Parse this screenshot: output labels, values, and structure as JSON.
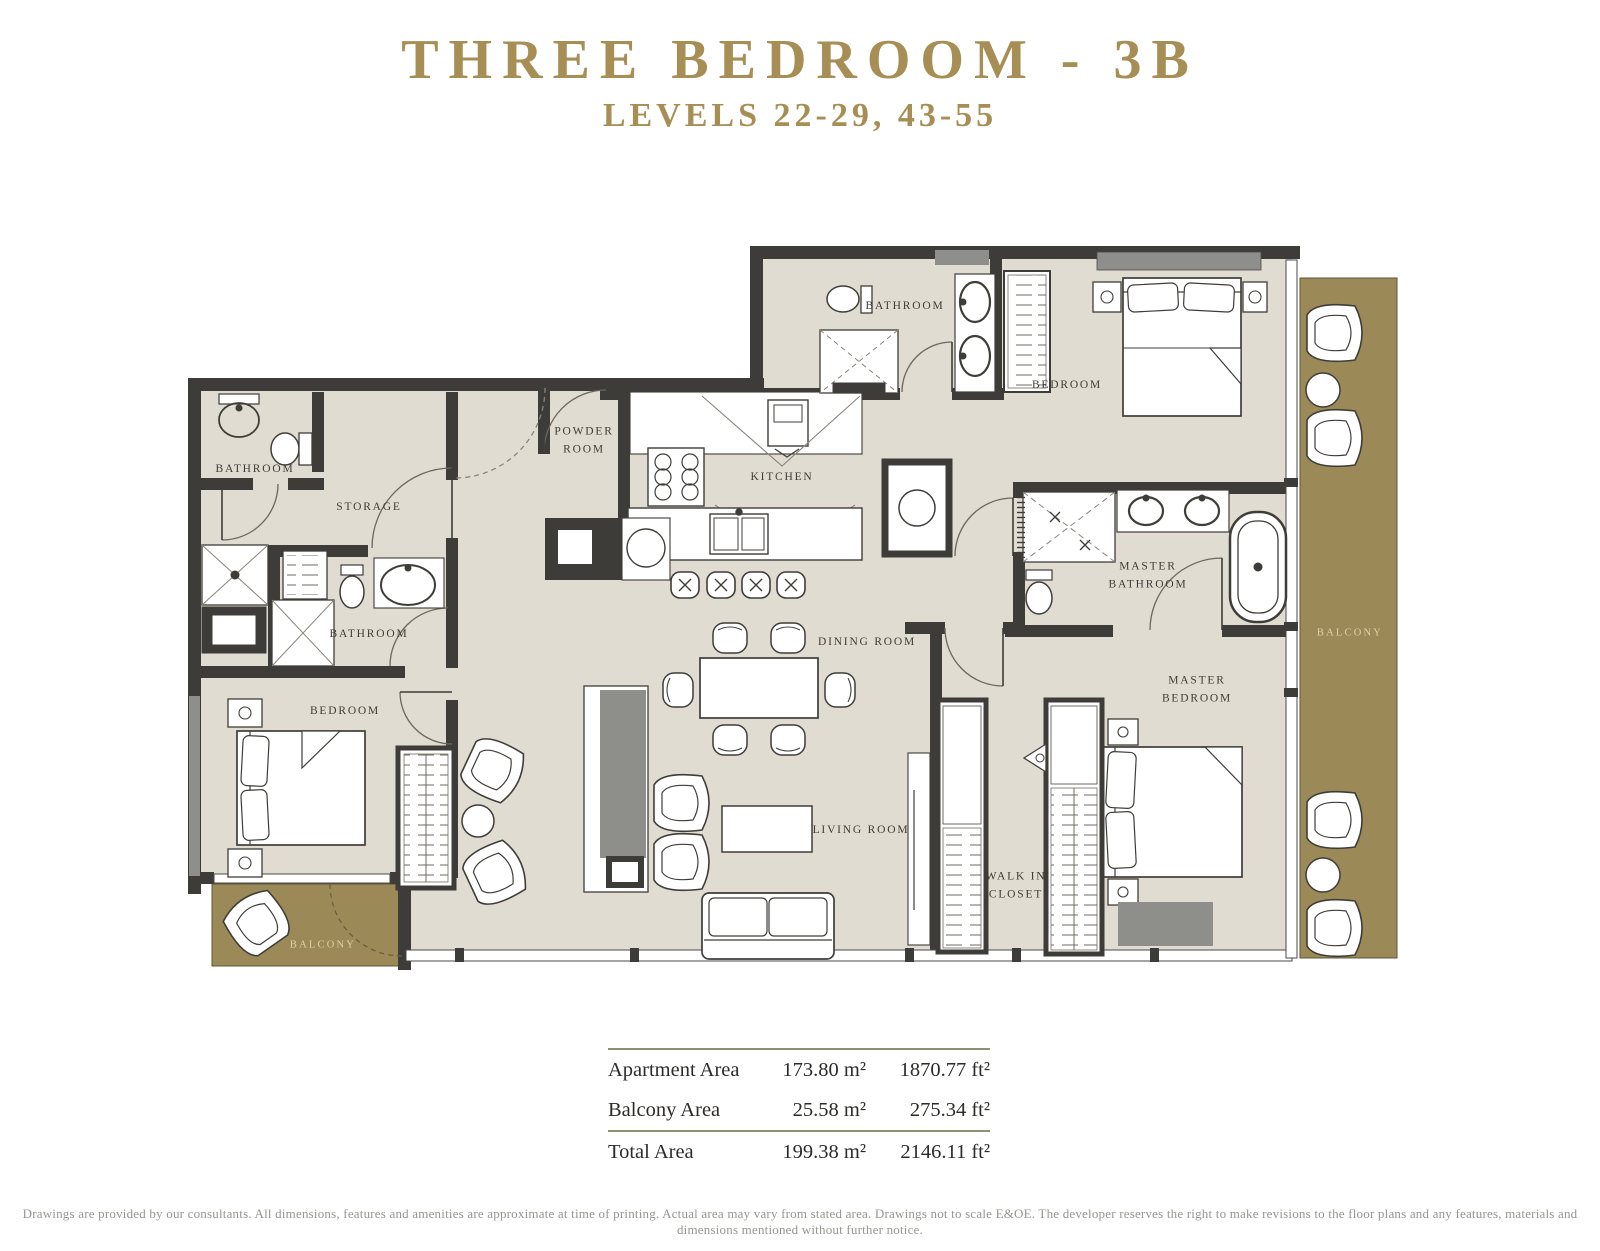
{
  "header": {
    "title": "THREE BEDROOM - 3B",
    "subtitle": "LEVELS 22-29, 43-55"
  },
  "floorplan": {
    "rooms": [
      {
        "id": "bathroom-1",
        "label": "BATHROOM"
      },
      {
        "id": "storage",
        "label": "STORAGE"
      },
      {
        "id": "bathroom-2",
        "label": "BATHROOM"
      },
      {
        "id": "bedroom-left",
        "label": "BEDROOM"
      },
      {
        "id": "powder-room",
        "label": "POWDER\nROOM"
      },
      {
        "id": "kitchen",
        "label": "KITCHEN"
      },
      {
        "id": "bathroom-top",
        "label": "BATHROOM"
      },
      {
        "id": "bedroom-top",
        "label": "BEDROOM"
      },
      {
        "id": "master-bathroom",
        "label": "MASTER\nBATHROOM"
      },
      {
        "id": "dining-room",
        "label": "DINING ROOM"
      },
      {
        "id": "living-room",
        "label": "LIVING ROOM"
      },
      {
        "id": "master-bedroom",
        "label": "MASTER\nBEDROOM"
      },
      {
        "id": "walk-in-closet",
        "label": "WALK IN\nCLOSET"
      },
      {
        "id": "balcony-right",
        "label": "BALCONY"
      },
      {
        "id": "balcony-left",
        "label": "BALCONY"
      }
    ]
  },
  "area_table": {
    "rows": [
      {
        "label": "Apartment Area",
        "metric": "173.80 m²",
        "imperial": "1870.77 ft²"
      },
      {
        "label": "Balcony Area",
        "metric": "25.58 m²",
        "imperial": "275.34 ft²"
      },
      {
        "label": "Total Area",
        "metric": "199.38 m²",
        "imperial": "2146.11 ft²"
      }
    ]
  },
  "disclaimer": "Drawings are provided by our consultants. All dimensions, features and amenities are approximate at time of printing. Actual area may vary from stated area. Drawings not to scale E&OE. The developer reserves the right to make revisions to the floor plans and any features, materials and dimensions mentioned without further notice.",
  "colors": {
    "accent_gold": "#a68e54",
    "balcony_fill": "#9b8a58",
    "wall": "#3d3c38",
    "floor": "#e0dcd2",
    "window_gray": "#8e8e8b"
  }
}
